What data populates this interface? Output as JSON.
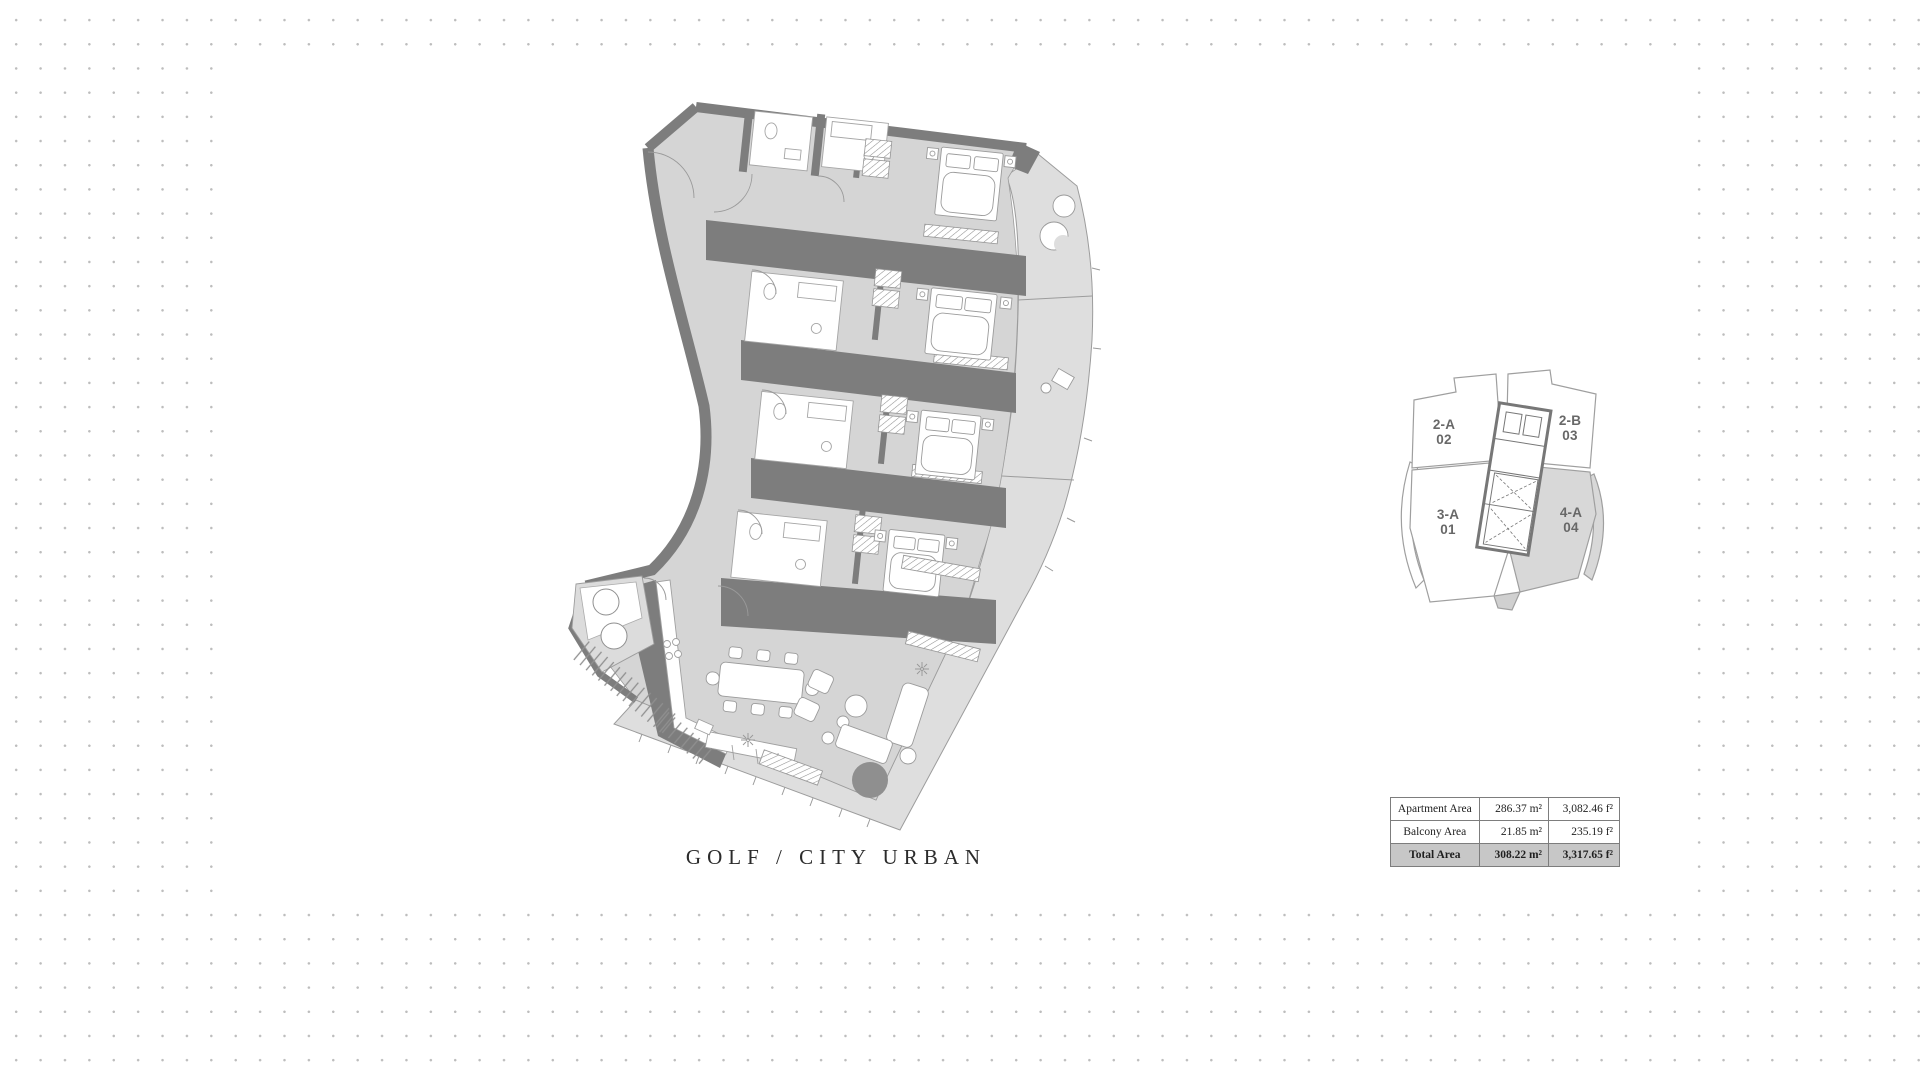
{
  "caption": "GOLF / CITY URBAN",
  "keyplan": {
    "units": [
      {
        "code": "2-A",
        "number": "02",
        "highlighted": false
      },
      {
        "code": "2-B",
        "number": "03",
        "highlighted": false
      },
      {
        "code": "3-A",
        "number": "01",
        "highlighted": false
      },
      {
        "code": "4-A",
        "number": "04",
        "highlighted": true
      }
    ]
  },
  "area_table": {
    "rows": [
      {
        "label": "Apartment Area",
        "metric": "286.37 m²",
        "imperial": "3,082.46 f²"
      },
      {
        "label": "Balcony Area",
        "metric": "21.85 m²",
        "imperial": "235.19 f²"
      },
      {
        "label": "Total Area",
        "metric": "308.22 m²",
        "imperial": "3,317.65 f²"
      }
    ]
  },
  "colors": {
    "wall": "#7d7d7d",
    "floor": "#d5d5d5",
    "balcony": "#dedede",
    "highlight_unit": "#d8d8d8",
    "table_total_bg": "#c7c7c7",
    "dots": "#bdbdbd",
    "rug": "#8f8f8f"
  }
}
